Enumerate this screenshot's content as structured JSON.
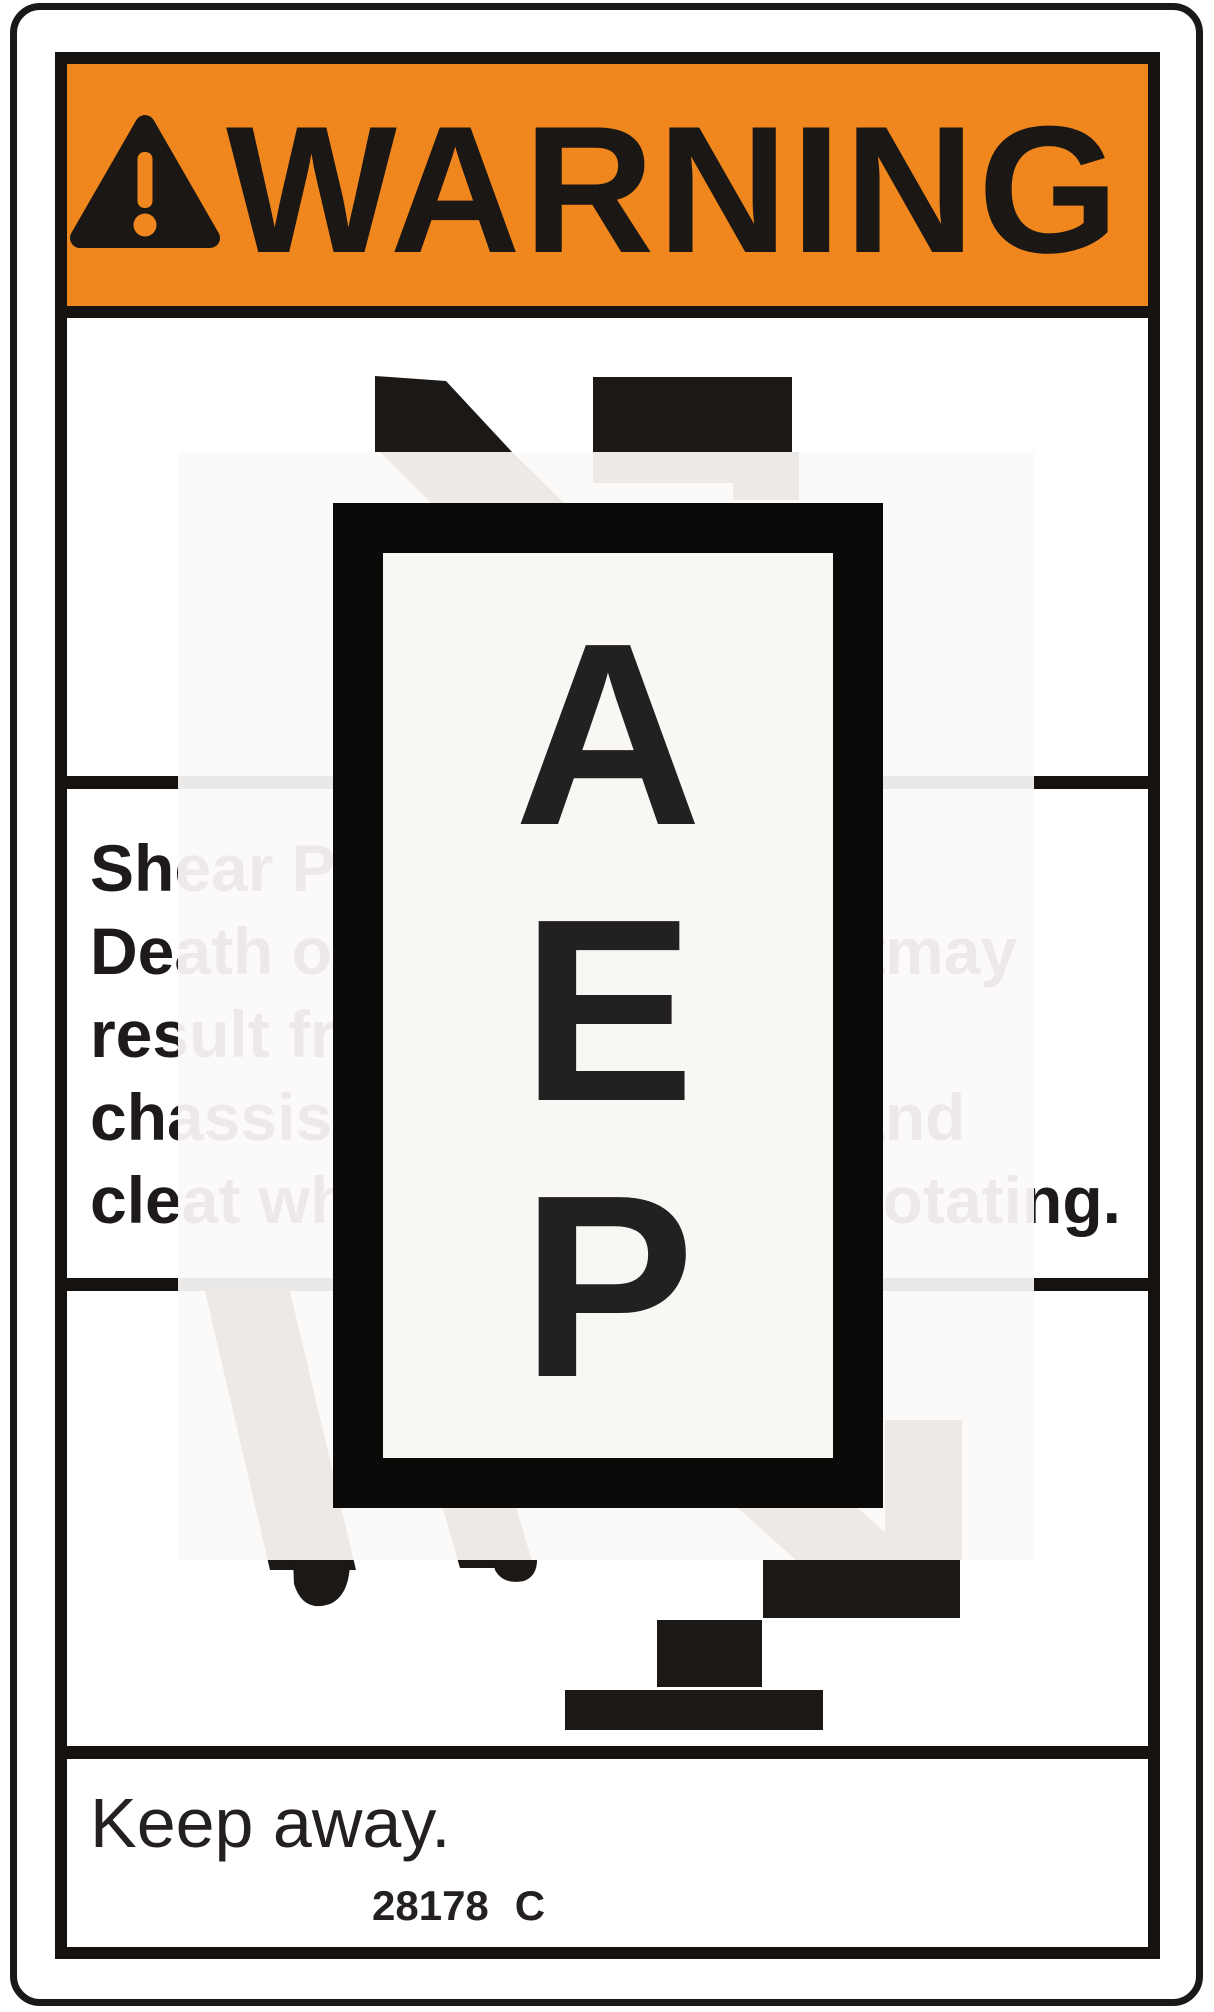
{
  "colors": {
    "safety_orange": "#F0861E",
    "ink": "#16120F",
    "overlay_tint": "#FBF9F6"
  },
  "header": {
    "signal_word": "WARNING",
    "alert_icon": "exclamation-triangle"
  },
  "pictogram": {
    "icon": "machine-shear-point-illustration"
  },
  "hazard_text": {
    "lines": [
      {
        "segments": [
          {
            "x": 90,
            "text": "Shear Point."
          }
        ]
      },
      {
        "segments": [
          {
            "x": 90,
            "text": "Death or dismemberment"
          },
          {
            "x": 885,
            "text": "may"
          }
        ]
      },
      {
        "segments": [
          {
            "x": 90,
            "text": "result from contact with"
          }
        ]
      },
      {
        "segments": [
          {
            "x": 90,
            "text": "chassis"
          },
          {
            "x": 848,
            "text": "and"
          }
        ]
      },
      {
        "segments": [
          {
            "x": 90,
            "text": "cleat while"
          },
          {
            "x": 857,
            "text": "rotating."
          }
        ]
      }
    ]
  },
  "action_text": "Keep away.",
  "footer": {
    "part_number": "28178",
    "revision": "C"
  },
  "watermark": {
    "letters": [
      "A",
      "E",
      "P"
    ]
  }
}
